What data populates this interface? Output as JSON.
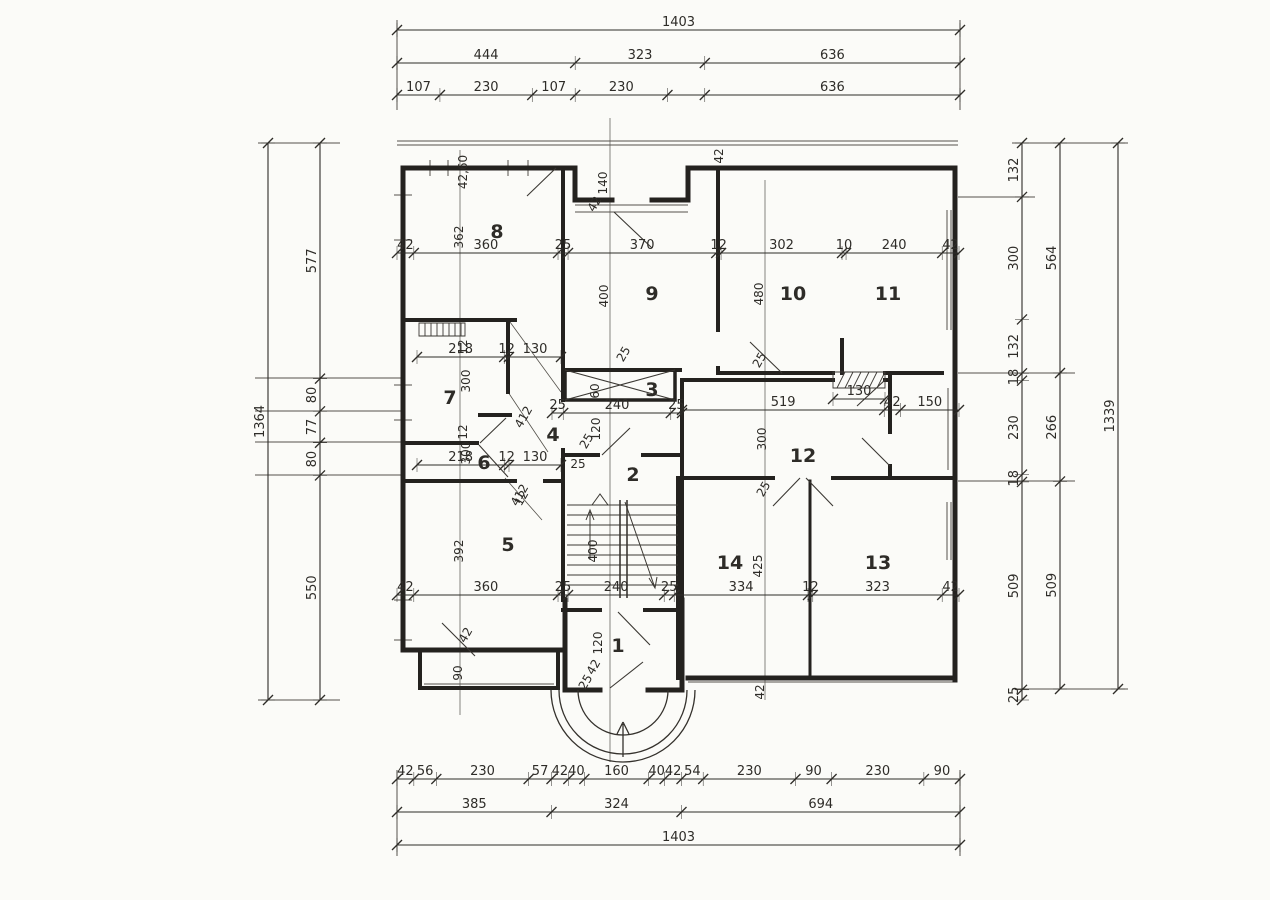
{
  "palette": {
    "ink": "#2e2c28",
    "thin_line": "#55524c",
    "paper": "#fbfbf8"
  },
  "drawing_type": "architectural floor plan, hand drawn with dimension chains (cm)",
  "rooms": [
    {
      "n": "8",
      "x": 497,
      "y": 238
    },
    {
      "n": "9",
      "x": 652,
      "y": 300
    },
    {
      "n": "10",
      "x": 793,
      "y": 300
    },
    {
      "n": "11",
      "x": 888,
      "y": 300
    },
    {
      "n": "7",
      "x": 450,
      "y": 404
    },
    {
      "n": "6",
      "x": 484,
      "y": 469
    },
    {
      "n": "3",
      "x": 652,
      "y": 396
    },
    {
      "n": "4",
      "x": 553,
      "y": 441
    },
    {
      "n": "2",
      "x": 633,
      "y": 481
    },
    {
      "n": "12",
      "x": 803,
      "y": 462
    },
    {
      "n": "14",
      "x": 730,
      "y": 569
    },
    {
      "n": "13",
      "x": 878,
      "y": 569
    },
    {
      "n": "1",
      "x": 618,
      "y": 652
    },
    {
      "n": "5",
      "x": 508,
      "y": 551
    }
  ],
  "chains": [
    {
      "id": "top-total",
      "o": "h",
      "y": 30,
      "a": 397,
      "b": 960,
      "v": [
        1403
      ],
      "l": [
        "1403"
      ]
    },
    {
      "id": "top-mid",
      "o": "h",
      "y": 63,
      "a": 397,
      "b": 960,
      "v": [
        444,
        323,
        636
      ],
      "l": [
        "444",
        "323",
        "636"
      ]
    },
    {
      "id": "top-fine",
      "o": "h",
      "y": 95,
      "a": 397,
      "b": 960,
      "v": [
        107,
        230,
        107,
        230,
        93,
        636
      ],
      "l": [
        "107",
        "230",
        "107",
        "230",
        "",
        "636"
      ]
    },
    {
      "id": "bottom-fine",
      "o": "h",
      "y": 779,
      "a": 397,
      "b": 960,
      "v": [
        42,
        56,
        230,
        57,
        42,
        40,
        160,
        40,
        42,
        54,
        230,
        90,
        230,
        90
      ],
      "l": [
        "42",
        "56",
        "230",
        "57",
        "42",
        "40",
        "160",
        "40",
        "42",
        "54",
        "230",
        "90",
        "230",
        "90"
      ]
    },
    {
      "id": "bottom-mid",
      "o": "h",
      "y": 812,
      "a": 397,
      "b": 960,
      "v": [
        385,
        324,
        694
      ],
      "l": [
        "385",
        "324",
        "694"
      ]
    },
    {
      "id": "bottom-total",
      "o": "h",
      "y": 845,
      "a": 397,
      "b": 960,
      "v": [
        1403
      ],
      "l": [
        "1403"
      ]
    },
    {
      "id": "left-total",
      "o": "v",
      "x": 268,
      "a": 143,
      "b": 700,
      "v": [
        1364
      ],
      "l": [
        "1364"
      ]
    },
    {
      "id": "left-fine",
      "o": "v",
      "x": 320,
      "a": 143,
      "b": 700,
      "v": [
        577,
        80,
        77,
        80,
        550
      ],
      "l": [
        "577",
        "80",
        "77",
        "80",
        "550"
      ]
    },
    {
      "id": "right-fine",
      "o": "v",
      "x": 1022,
      "a": 143,
      "b": 700,
      "v": [
        132,
        300,
        132,
        18,
        230,
        18,
        509,
        25
      ],
      "l": [
        "132",
        "300",
        "132",
        "18",
        "230",
        "18",
        "509",
        "25"
      ]
    },
    {
      "id": "right-mid",
      "o": "v",
      "x": 1060,
      "a": 143,
      "b": 689,
      "v": [
        564,
        266,
        509
      ],
      "l": [
        "564",
        "266",
        "509"
      ]
    },
    {
      "id": "right-total",
      "o": "v",
      "x": 1118,
      "a": 143,
      "b": 689,
      "v": [
        1339
      ],
      "l": [
        "1339"
      ]
    },
    {
      "id": "plan-row-upper",
      "o": "h",
      "y": 253,
      "a": 397,
      "b": 959,
      "v": [
        42,
        360,
        25,
        370,
        12,
        302,
        10,
        240,
        42
      ],
      "l": [
        "42",
        "360",
        "25",
        "370",
        "12",
        "302",
        "10",
        "240",
        "42"
      ]
    },
    {
      "id": "plan-row-lower",
      "o": "h",
      "y": 595,
      "a": 397,
      "b": 959,
      "v": [
        42,
        360,
        25,
        240,
        25,
        334,
        12,
        323,
        42
      ],
      "l": [
        "42",
        "360",
        "25",
        "240",
        "25",
        "334",
        "12",
        "323",
        "42"
      ]
    },
    {
      "id": "stair-row",
      "o": "h",
      "y": 413,
      "a": 552,
      "b": 682,
      "v": [
        25,
        240,
        25
      ],
      "l": [
        "25",
        "240",
        "25"
      ]
    },
    {
      "id": "room12-row",
      "o": "h",
      "y": 410,
      "a": 682,
      "b": 959,
      "v": [
        519,
        42,
        150
      ],
      "l": [
        "519",
        "42",
        "150"
      ]
    },
    {
      "id": "room7-row",
      "o": "h",
      "y": 357,
      "a": 417,
      "b": 561,
      "v": [
        218,
        12,
        130
      ],
      "l": [
        "218",
        "12",
        "130"
      ]
    },
    {
      "id": "room6-row",
      "o": "h",
      "y": 465,
      "a": 417,
      "b": 561,
      "v": [
        218,
        12,
        130
      ],
      "l": [
        "218",
        "12",
        "130"
      ]
    },
    {
      "id": "niche-row",
      "o": "h",
      "y": 399,
      "a": 833,
      "b": 885,
      "v": [
        130
      ],
      "l": [
        "130"
      ]
    }
  ],
  "labels": [
    {
      "t": "42,60",
      "x": 467,
      "y": 172,
      "r": -90
    },
    {
      "t": "362",
      "x": 463,
      "y": 237,
      "r": -90
    },
    {
      "t": "140",
      "x": 607,
      "y": 183,
      "r": -90
    },
    {
      "t": "42",
      "x": 598,
      "y": 206,
      "r": -60
    },
    {
      "t": "42",
      "x": 723,
      "y": 156,
      "r": -90
    },
    {
      "t": "400",
      "x": 608,
      "y": 296,
      "r": -90
    },
    {
      "t": "480",
      "x": 763,
      "y": 294,
      "r": -90
    },
    {
      "t": "25",
      "x": 763,
      "y": 362,
      "r": -60
    },
    {
      "t": "25",
      "x": 627,
      "y": 356,
      "r": -60
    },
    {
      "t": "60",
      "x": 599,
      "y": 391,
      "r": -90
    },
    {
      "t": "300",
      "x": 470,
      "y": 381,
      "r": -90
    },
    {
      "t": "412",
      "x": 527,
      "y": 419,
      "r": -60
    },
    {
      "t": "412",
      "x": 523,
      "y": 497,
      "r": -60
    },
    {
      "t": "12",
      "x": 467,
      "y": 347,
      "r": -90
    },
    {
      "t": "12",
      "x": 467,
      "y": 432,
      "r": -90
    },
    {
      "t": "300",
      "x": 470,
      "y": 453,
      "r": -90
    },
    {
      "t": "120",
      "x": 600,
      "y": 429,
      "r": -90
    },
    {
      "t": "25",
      "x": 590,
      "y": 443,
      "r": -60
    },
    {
      "t": "392",
      "x": 463,
      "y": 551,
      "r": -90
    },
    {
      "t": "90",
      "x": 462,
      "y": 673,
      "r": -90
    },
    {
      "t": "42",
      "x": 469,
      "y": 637,
      "r": -60
    },
    {
      "t": "12",
      "x": 525,
      "y": 500,
      "r": -60
    },
    {
      "t": "400",
      "x": 597,
      "y": 551,
      "r": -90
    },
    {
      "t": "25",
      "x": 578,
      "y": 468,
      "r": 0
    },
    {
      "t": "120",
      "x": 602,
      "y": 643,
      "r": -90
    },
    {
      "t": "42",
      "x": 597,
      "y": 669,
      "r": -60
    },
    {
      "t": "25",
      "x": 589,
      "y": 684,
      "r": -60
    },
    {
      "t": "42",
      "x": 764,
      "y": 692,
      "r": -90
    },
    {
      "t": "425",
      "x": 762,
      "y": 566,
      "r": -90
    },
    {
      "t": "300",
      "x": 766,
      "y": 439,
      "r": -90
    },
    {
      "t": "25",
      "x": 767,
      "y": 491,
      "r": -60
    }
  ]
}
